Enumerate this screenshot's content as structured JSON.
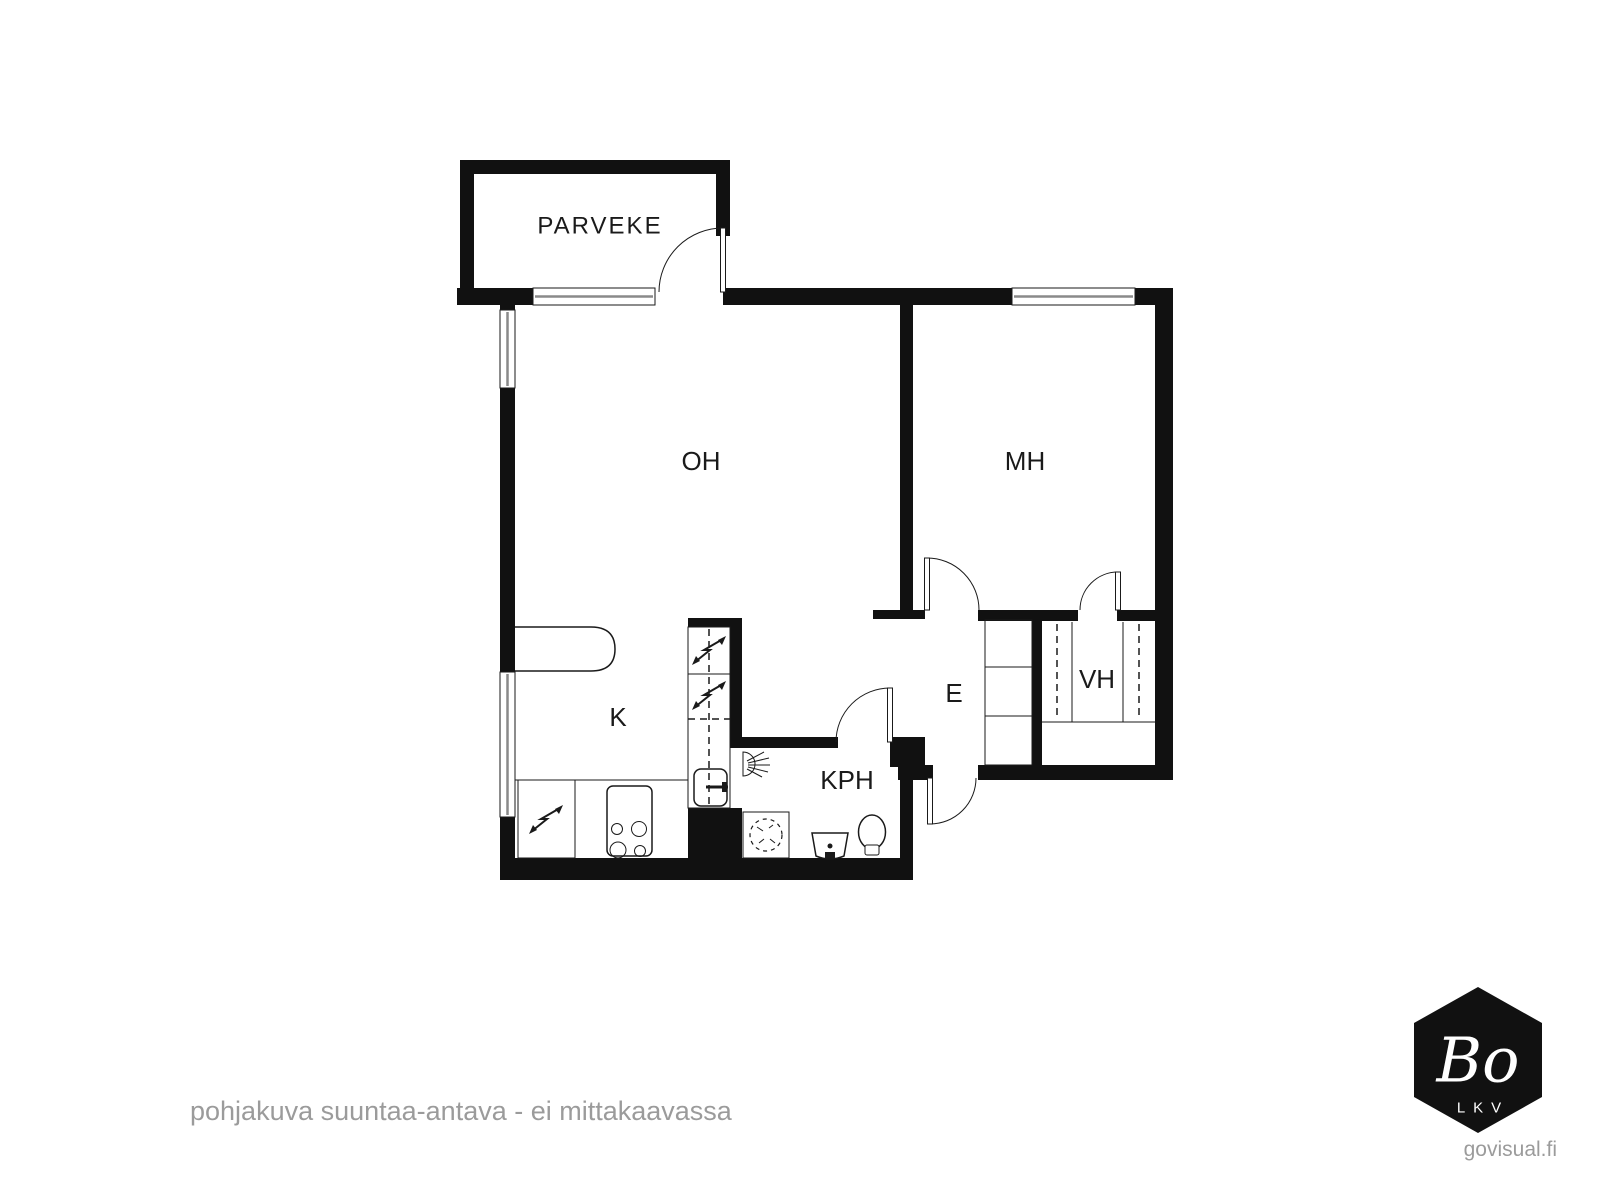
{
  "floorplan": {
    "rooms": [
      {
        "id": "parveke",
        "label": "PARVEKE"
      },
      {
        "id": "oh",
        "label": "OH"
      },
      {
        "id": "mh",
        "label": "MH"
      },
      {
        "id": "k",
        "label": "K"
      },
      {
        "id": "kph",
        "label": "KPH"
      },
      {
        "id": "e",
        "label": "E"
      },
      {
        "id": "vh",
        "label": "VH"
      }
    ],
    "fixtures": [
      "balcony-door",
      "living-room-window",
      "bedroom-window",
      "kitchen-window",
      "kitchen-counter",
      "refrigerator",
      "freezer",
      "kitchen-sink",
      "dishwasher",
      "stove",
      "shower",
      "washing-machine",
      "bathroom-sink",
      "toilet",
      "hall-cabinet",
      "wardrobe-rails",
      "front-door"
    ],
    "colors": {
      "wall": "#111111",
      "line": "#1a1a1a",
      "window_pane": "#8a8a8a",
      "text": "#1a1a1a"
    }
  },
  "footer": {
    "disclaimer": "pohjakuva suuntaa-antava - ei mittakaavassa",
    "credit": "govisual.fi",
    "text_color": "#9b9b9b"
  },
  "logo": {
    "brand": "Bo",
    "sub": "LKV",
    "bg": "#111111",
    "fg": "#ffffff"
  }
}
